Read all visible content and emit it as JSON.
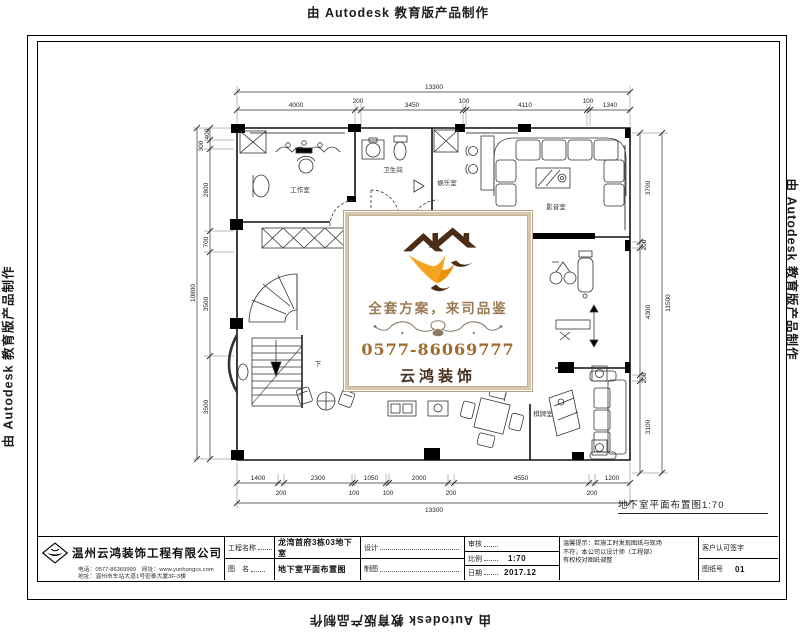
{
  "stamp": {
    "text": "由 Autodesk 教育版产品制作"
  },
  "watermark": {
    "slogan": "全套方案，来司品鉴",
    "phone": "0577-86069777",
    "brand": "云鸿装饰",
    "colors": {
      "roof_brown": "#4a2c17",
      "swoosh_orange": "#f5a41f",
      "slogan_brown": "#9b7b55",
      "phone_brown": "#a06b2f",
      "border_beige": "#d6c6ae"
    }
  },
  "plan": {
    "caption": "地下室平面布置图1:70",
    "rooms": {
      "workroom": "工作室",
      "bathroom": "卫生间",
      "recreation": "娱乐室",
      "media": "影音室",
      "chess": "棋牌室",
      "stair_down": "下"
    },
    "dims": {
      "top": {
        "overall": "13300",
        "segments": [
          "4000",
          "200",
          "3450",
          "100",
          "4110",
          "100",
          "1340"
        ]
      },
      "bottom": {
        "overall": "13300",
        "row1": [
          "1400",
          "2300",
          "1050",
          "2000",
          "4550",
          "1200"
        ],
        "row2": [
          "200",
          "100",
          "100",
          "200",
          "200"
        ]
      },
      "left": {
        "overall": "10800",
        "segments": [
          "400",
          "300",
          "2800",
          "700",
          "3500",
          "3500"
        ]
      },
      "right": {
        "overall": "11500",
        "segments": [
          "3700",
          "200",
          "4300",
          "200",
          "3100"
        ]
      }
    }
  },
  "title_block": {
    "company": "温州云鸿装饰工程有限公司",
    "contact_line1": "电话：0577-86369999　网址：www.yunhongcs.com",
    "contact_line2": "地址：温州市车站大道1号密泰大厦3F-3楼",
    "project_label": "工程名称",
    "project_value": "龙湾首府3栋03地下室",
    "drawing_label": "图　名",
    "drawing_value": "地下室平面布置图",
    "design_label": "设计",
    "draft_label": "制图",
    "audit_label": "审核",
    "scale_label": "比例",
    "scale_value": "1:70",
    "date_label": "日期",
    "date_value": "2017.12",
    "notice_line1": "温馨提示：若施工时发现图纸与现场",
    "notice_line2": "不符，本公司以设计师（工程部）",
    "notice_line3": "有权校对图纸调整",
    "sign_label": "客户认可签字",
    "sheet_label": "图纸号",
    "sheet_value": "01"
  }
}
